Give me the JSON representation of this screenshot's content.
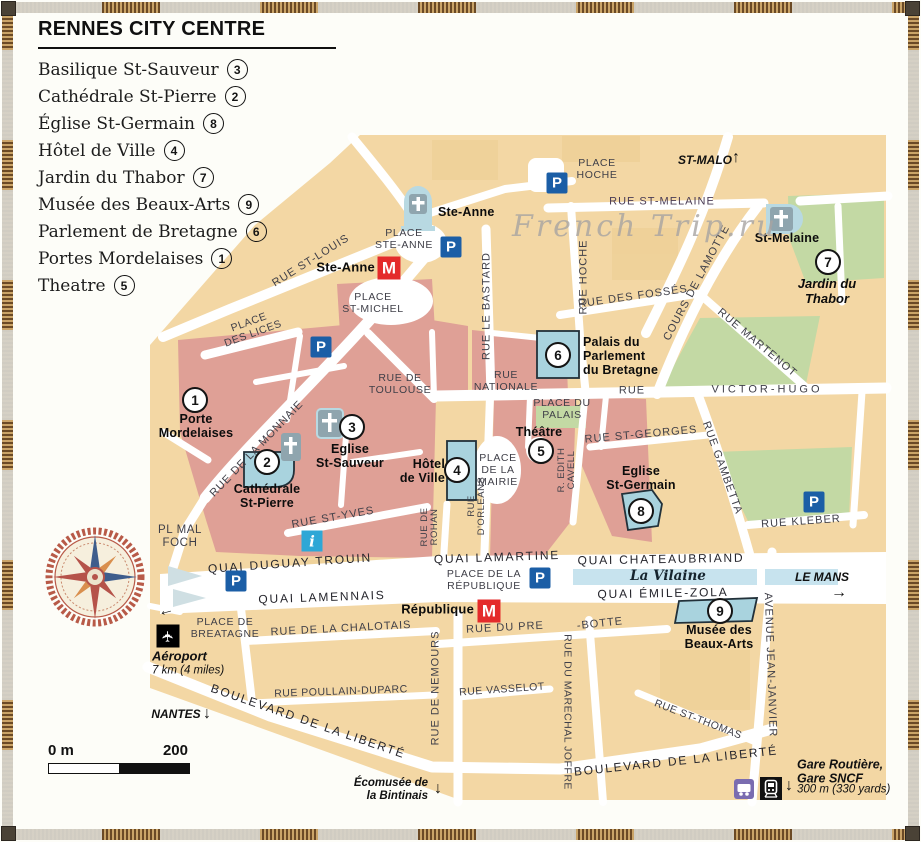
{
  "legend": {
    "title": "RENNES CITY CENTRE",
    "items": [
      {
        "label": "Basilique St-Sauveur",
        "num": "3"
      },
      {
        "label": "Cathédrale St-Pierre",
        "num": "2"
      },
      {
        "label": "Église St-Germain",
        "num": "8"
      },
      {
        "label": "Hôtel de Ville",
        "num": "4"
      },
      {
        "label": "Jardin du Thabor",
        "num": "7"
      },
      {
        "label": "Musée des Beaux-Arts",
        "num": "9"
      },
      {
        "label": "Parlement de Bretagne",
        "num": "6"
      },
      {
        "label": "Portes Mordelaises",
        "num": "1"
      },
      {
        "label": "Theatre",
        "num": "5"
      }
    ]
  },
  "watermark": "French Trip.ru",
  "icons": {
    "parking": "P",
    "metro": "M",
    "info": "i",
    "plane": "✈",
    "up": "↑",
    "down": "↓",
    "right": "→",
    "left": "←"
  },
  "markers": {
    "porte": "1",
    "cathedrale": "2",
    "st_sauveur": "3",
    "hotel_de_ville": "4",
    "theatre": "5",
    "parlement": "6",
    "thabor": "7",
    "st_germain": "8",
    "musee": "9"
  },
  "streets": {
    "rue_st_louis": "RUE ST-LOUIS",
    "place_des_lices": "PLACE\nDES LICES",
    "rue_st_melaine": "RUE ST-MELAINE",
    "rue_des_fosses": "RUE DES FOSSÉS",
    "cours_de_lamotte": "COURS DE LAMOTTE",
    "rue_martenot": "RUE MARTENOT",
    "rue_hoche": "RUE HOCHE",
    "rue_le_bastard": "RUE LE BASTARD",
    "rue_de_toulouse": "RUE DE\nTOULOUSE",
    "rue_nationale": "RUE\nNATIONALE",
    "rue_label": "RUE",
    "victor_hugo": "VICTOR-HUGO",
    "rue_de_la_monnaie": "RUE DE LA MONNAIE",
    "rue_st_georges": "RUE ST-GEORGES",
    "r_edith_cavell": "R. EDITH\nCAVELL",
    "rue_gambetta": "RUE GAMBETTA",
    "rue_kleber": "RUE KLEBER",
    "rue_st_yves": "RUE ST-YVES",
    "rue_de_rohan": "RUE DE\nROHAN",
    "rue_dorleans": "RUE\nD'ORLEANS",
    "quai_duguay_trouin": "QUAI DUGUAY TROUIN",
    "quai_lamennais": "QUAI LAMENNAIS",
    "quai_lamartine": "QUAI LAMARTINE",
    "quai_chateaubriand": "QUAI CHATEAUBRIAND",
    "quai_emile_zola": "QUAI ÉMILE-ZOLA",
    "rue_de_la_chalotais": "RUE DE LA CHALOTAIS",
    "rue_du_pre": "RUE DU PRE",
    "botte": "-BOTTE",
    "rue_de_nemours": "RUE DE NEMOURS",
    "rue_poullain_duparc": "RUE POULLAIN-DUPARC",
    "rue_vasselot": "RUE VASSELOT",
    "rue_du_marechal_joffre": "RUE DU MARECHAL JOFFRE",
    "boulevard_liberte": "BOULEVARD DE LA LIBERTÉ",
    "rue_st_thomas": "RUE ST-THOMAS",
    "avenue_jean_janvier": "AVENUE JEAN-JANVIER"
  },
  "places": {
    "place_ste_anne": "PLACE\nSTE-ANNE",
    "place_st_michel": "PLACE\nST-MICHEL",
    "place_hoche": "PLACE\nHOCHE",
    "place_du_palais": "PLACE DU\nPALAIS",
    "place_de_la_mairie": "PLACE\nDE LA\nMAIRIE",
    "place_de_la_republique": "PLACE DE LA\nRÉPUBLIQUE",
    "place_de_bretagne": "PLACE DE\nBREATAGNE",
    "pl_mal_foch": "PL MAL\nFOCH"
  },
  "landmarks": {
    "ste_anne": "Ste-Anne",
    "st_melaine": "St-Melaine",
    "jardin_du_thabor": "Jardin du\nThabor",
    "palais_parlement": "Palais du\nParlement\ndu Bretagne",
    "theatre": "Théâtre",
    "eglise_st_germain": "Eglise\nSt-Germain",
    "eglise_st_sauveur": "Eglise\nSt-Sauveur",
    "cathedrale_st_pierre": "Cathédrale\nSt-Pierre",
    "hotel_de_ville": "Hôtel\nde Ville",
    "porte_mordelaises": "Porte\nMordelaises",
    "musee_beaux_arts": "Musée des\nBeaux-Arts"
  },
  "metro_stations": {
    "ste_anne": "Ste-Anne",
    "republique": "République"
  },
  "river": {
    "name": "La Vilaine"
  },
  "directions": {
    "st_malo": "ST-MALO",
    "nantes": "NANTES",
    "le_mans": "LE MANS",
    "ecomusee": "Écomusée de\nla Bintinais",
    "aeroport_name": "Aéroport",
    "aeroport_distance": "7 km (4 miles)",
    "gare_name": "Gare Routière,\nGare SNCF",
    "gare_distance": "300 m (330 yards)"
  },
  "scale": {
    "start": "0 m",
    "end": "200"
  },
  "colors": {
    "parking": "#1b5ea6",
    "metro": "#e42b2b",
    "info": "#2ea7d6",
    "water": "#c7e3ee",
    "park": "#c3d9a4",
    "old_town": "#dfa096",
    "block": "#f3d7a4",
    "building": "#a9d3de"
  }
}
